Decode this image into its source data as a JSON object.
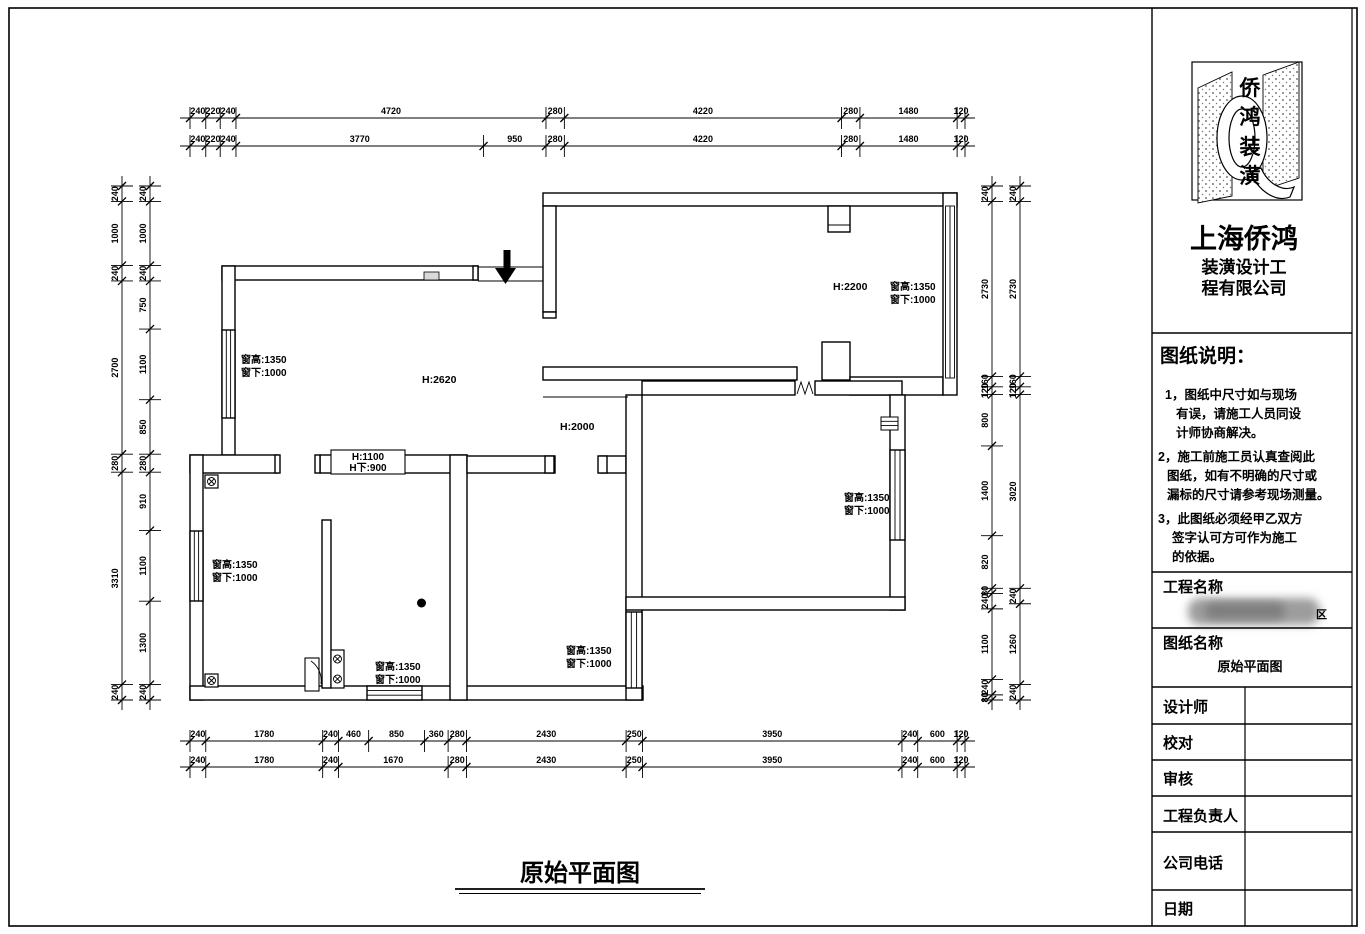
{
  "sheet": {
    "bg": "#ffffff",
    "line_color": "#000000"
  },
  "panel": {
    "logo_chars": [
      "侨",
      "鸿",
      "装",
      "潢"
    ],
    "company_name": "上海侨鸿",
    "company_sub1": "装潢设计工",
    "company_sub2": "程有限公司",
    "notes_title": "图纸说明：",
    "notes": [
      {
        "lines": [
          "1，图纸中尺寸如与现场",
          "有误，请施工人员同设",
          "计师协商解决。"
        ]
      },
      {
        "lines": [
          "2，施工前施工员认真查阅此",
          "图纸，如有不明确的尺寸或",
          "漏标的尺寸请参考现场测量。"
        ]
      },
      {
        "lines": [
          "3，此图纸必须经甲乙双方",
          "签字认可方可作为施工",
          "的依据。"
        ]
      }
    ],
    "project_label": "工程名称",
    "project_value_hint": "区",
    "drawing_label": "图纸名称",
    "drawing_value": "原始平面图",
    "rows": [
      {
        "label": "设计师",
        "value": ""
      },
      {
        "label": "校对",
        "value": ""
      },
      {
        "label": "审核",
        "value": ""
      },
      {
        "label": "工程负责人",
        "value": ""
      },
      {
        "label": "公司电话",
        "value": ""
      },
      {
        "label": "日期",
        "value": ""
      }
    ]
  },
  "title": {
    "text": "原始平面图"
  },
  "plan": {
    "labels": {
      "living_height": "H:2620",
      "sunroom_height": "H:2200",
      "hall_height": "H:2000",
      "lowwall_line1": "H:1100",
      "lowwall_line2": "H下:900"
    },
    "window_label": {
      "line1": "窗高:1350",
      "line2": "窗下:1000"
    }
  },
  "dimensions": {
    "top_row1": [
      240,
      220,
      240,
      4720,
      280,
      4220,
      280,
      1480,
      120
    ],
    "top_row2": [
      240,
      220,
      240,
      3770,
      950,
      280,
      4220,
      280,
      1480,
      120
    ],
    "bottom_row1": [
      240,
      1780,
      240,
      460,
      850,
      360,
      280,
      2430,
      250,
      3950,
      240,
      600,
      120
    ],
    "bottom_row2": [
      240,
      1780,
      240,
      1670,
      280,
      2430,
      250,
      3950,
      240,
      600,
      120
    ],
    "left_outer": [
      240,
      1000,
      240,
      2700,
      280,
      3310,
      240
    ],
    "left_inner": [
      240,
      1000,
      240,
      750,
      1100,
      850,
      280,
      910,
      1100,
      1300,
      240
    ],
    "right_inner": [
      240,
      2730,
      160,
      120,
      800,
      1400,
      820,
      80,
      240,
      1100,
      240,
      80
    ],
    "right_outer": [
      240,
      2730,
      160,
      120,
      3020,
      240,
      1260,
      240
    ]
  }
}
